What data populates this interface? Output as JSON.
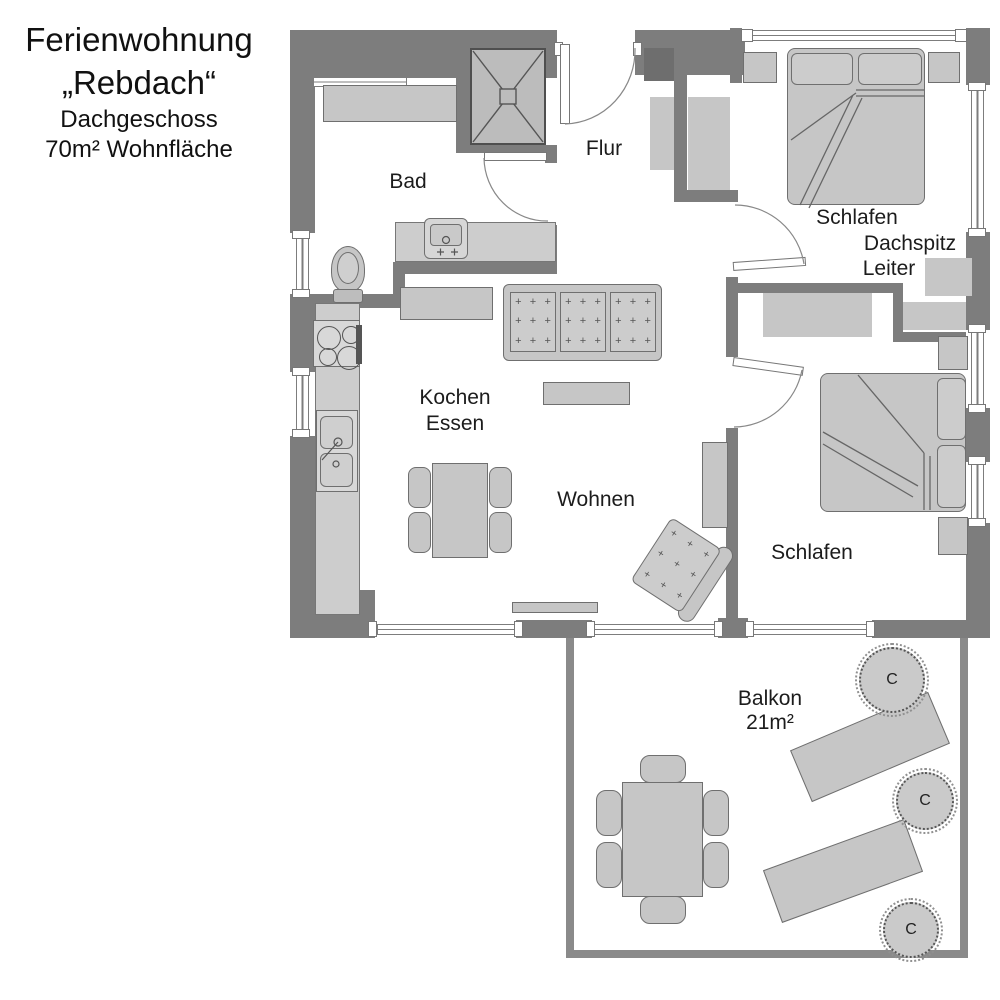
{
  "title": {
    "line1": "Ferienwohnung",
    "line2": "„Rebdach“",
    "line3": "Dachgeschoss",
    "line4": "70m² Wohnfläche"
  },
  "rooms": {
    "bad": "Bad",
    "flur": "Flur",
    "schlafen1": "Schlafen",
    "dachspitz": "Dachspitz",
    "leiter": "Leiter",
    "kochen": "Kochen",
    "essen": "Essen",
    "wohnen": "Wohnen",
    "schlafen2": "Schlafen",
    "balkon": "Balkon",
    "balkon_size": "21m²"
  },
  "plants": {
    "label": "C"
  },
  "decor": {
    "tuft_symbol": "+"
  },
  "colors": {
    "wall": "#7d7d7d",
    "chimney": "#6e6e6e",
    "balcony_wall": "#8a8a8a",
    "furniture_fill": "#c6c6c6",
    "furniture_stroke": "#6f6f6f",
    "background": "#ffffff",
    "text": "#1c1c1c"
  }
}
